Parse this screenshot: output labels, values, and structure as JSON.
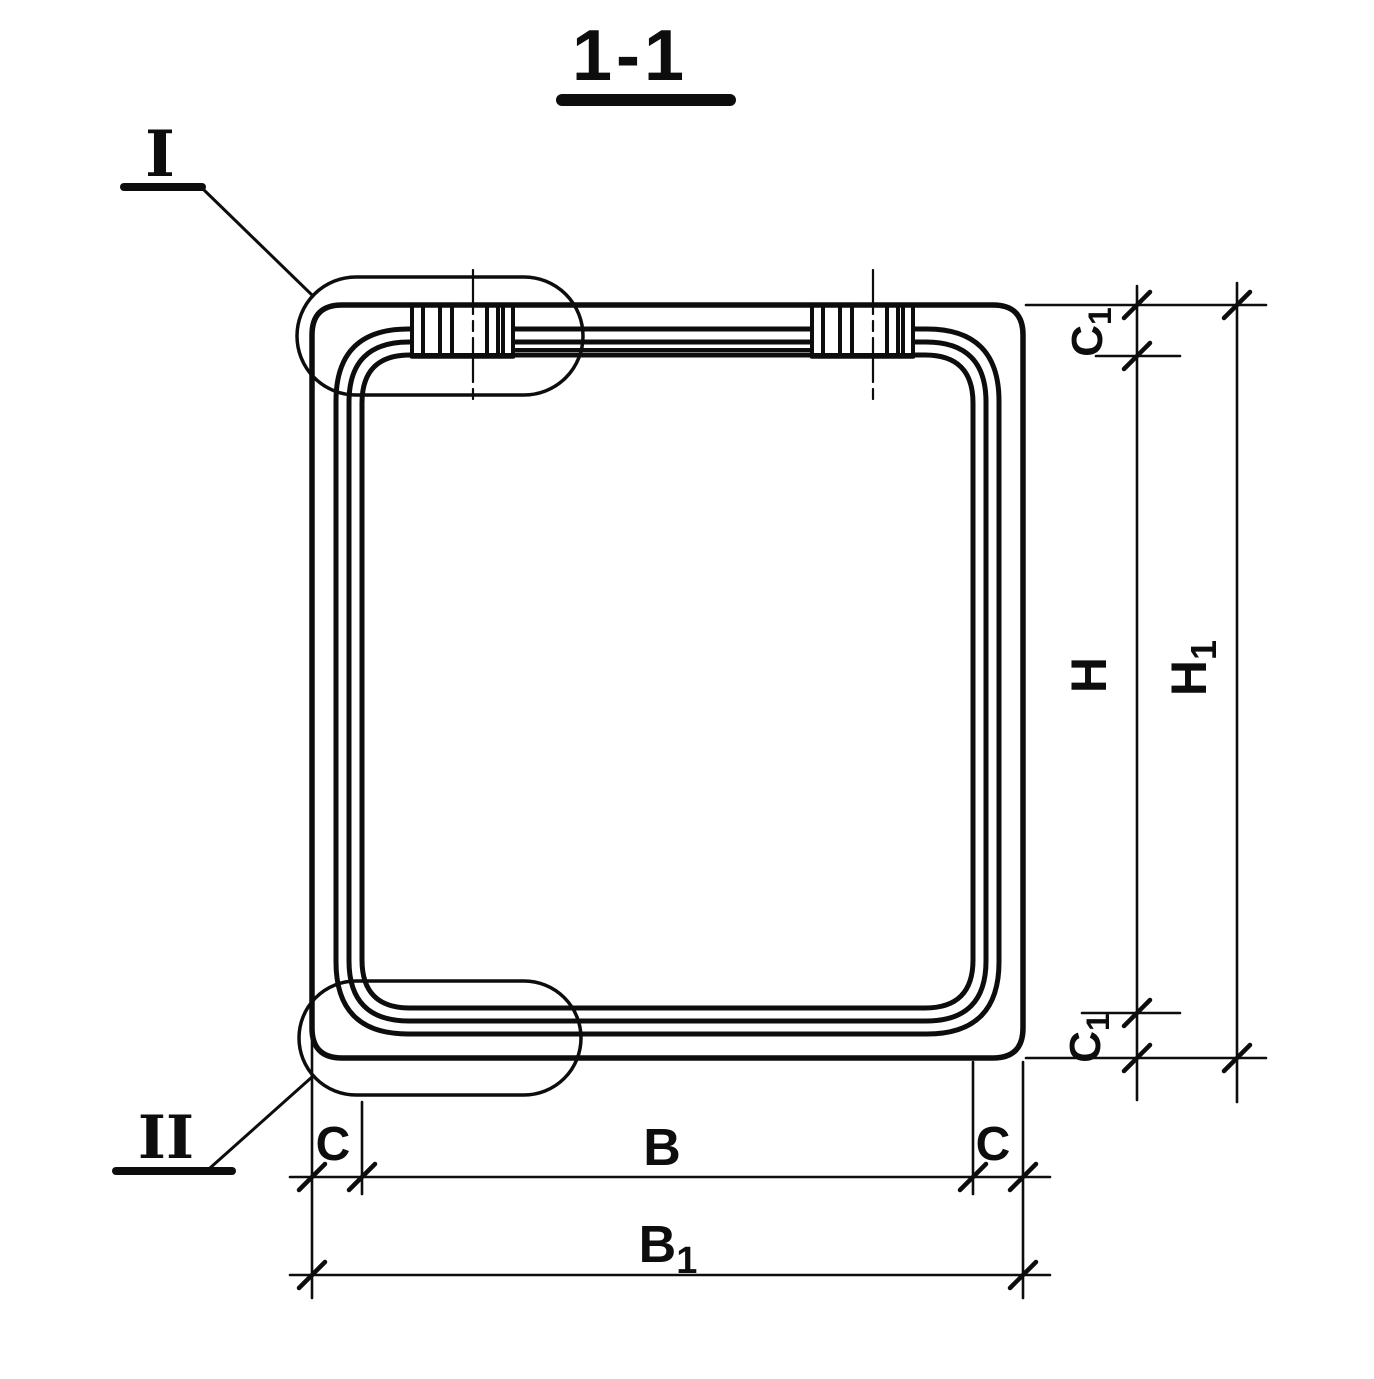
{
  "title": "1-1",
  "colors": {
    "ink": "#0d0d0d",
    "paper": "#ffffff"
  },
  "details": {
    "one": {
      "label": "I"
    },
    "two": {
      "label": "II"
    }
  },
  "dimensions": {
    "height_clear": {
      "main": "H",
      "sub": ""
    },
    "height_overall": {
      "main": "H",
      "sub": "1"
    },
    "width_clear": {
      "main": "B",
      "sub": ""
    },
    "width_overall": {
      "main": "B",
      "sub": "1"
    },
    "wall_left": {
      "main": "C",
      "sub": ""
    },
    "wall_right": {
      "main": "C",
      "sub": ""
    },
    "wall_top": {
      "main": "C",
      "sub": "1"
    },
    "wall_bottom": {
      "main": "C",
      "sub": "1"
    }
  }
}
